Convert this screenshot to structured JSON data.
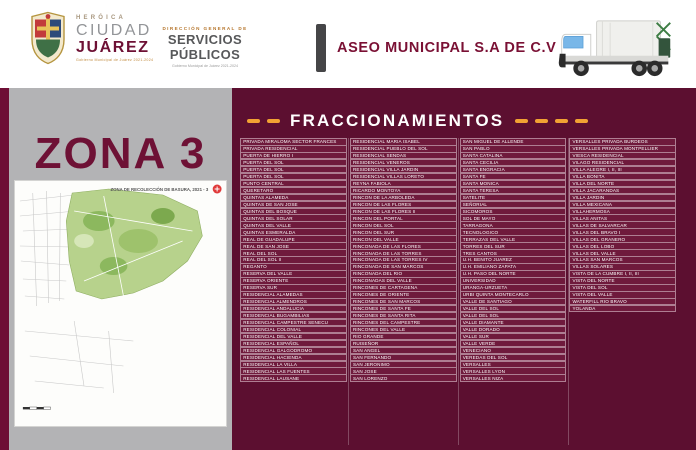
{
  "header": {
    "brand": {
      "heroica": "HERÓICA",
      "ciudad": "CIUDAD",
      "juarez": "JUÁREZ",
      "tagline": "Gobierno Municipal de Juárez 2021-2024"
    },
    "direction": {
      "small": "DIRECCIÓN GENERAL DE",
      "title": "SERVICIOS PÚBLICOS",
      "tagline": "Gobierno Municipal de Juárez 2021-2024"
    },
    "company": "ASEO MUNICIPAL S.A DE C.V"
  },
  "zone": {
    "title": "ZONA 3",
    "map_title": "ZONA DE RECOLECCIÓN DE BASURA, 2021 - 3"
  },
  "fraccionamientos": {
    "title": "FRACCIONAMIENTOS",
    "columns": [
      [
        "PRIVADA MIRALOMA SECTOR FRANCES",
        "PRIVADA RESIDENCIAL",
        "PUERTA DE HIERRO I",
        "PUERTA DEL SOL",
        "PUERTA DEL SOL",
        "PUERTA DEL SOL",
        "PUNTO CENTRAL",
        "QUERETARO",
        "QUINTAS ALAMEDA",
        "QUINTAS DE SAN JOSE",
        "QUINTAS DEL BOSQUE",
        "QUINTAS DEL SOLAR",
        "QUINTAS DEL VALLE",
        "QUINTAS ESMERALDA",
        "REAL DE GUADALUPE",
        "REAL DE SAN JOSE",
        "REAL DEL SOL",
        "REAL DEL SOL II",
        "REGANTO",
        "RESERVA DEL VALLE",
        "RESERVA ORIENTE",
        "RESERVA SUR",
        "RESIDENCIAL ALAMEDAS",
        "RESIDENCIAL ALMENDROS",
        "RESIDENCIAL ANDALUCIA",
        "RESIDENCIAL BUGAMBILIAS",
        "RESIDENCIAL CAMPESTRE SENECU",
        "RESIDENCIAL COLONIAL",
        "RESIDENCIAL DEL VALLE",
        "RESIDENCIAL ESPAÑOL",
        "RESIDENCIAL GALGODROMO",
        "RESIDENCIAL HACIENDA",
        "RESIDENCIAL LA VILLA",
        "RESIDENCIAL LAS FUENTES",
        "RESIDENCIAL LAUSANE"
      ],
      [
        "RESIDENCIAL MARIA ISABEL",
        "RESIDENCIAL PUEBLO DEL SOL",
        "RESIDENCIAL SENDAS",
        "RESIDENCIAL VENEROS",
        "RESIDENCIAL VILLA JARDIN",
        "RESIDENCIAL VILLAS LORETO",
        "REYNA FABIOLA",
        "RICARDO MONTOYA",
        "RINCON DE LA ARBOLEDA",
        "RINCON DE LAS FLORES",
        "RINCON DE LAS FLORES II",
        "RINCON DEL PORTAL",
        "RINCON DEL SOL",
        "RINCON DEL SUR",
        "RINCON DEL VALLE",
        "RINCONADA DE LAS FLORES",
        "RINCONADA DE LAS TORRES",
        "RINCONADA DE LAS TORRES IV",
        "RINCONADA DE SAN MARCOS",
        "RINCONADA DEL RIO",
        "RINCONADAS DEL VALLE",
        "RINCONES DE CARTAGENA",
        "RINCONES DE ORIENTE",
        "RINCONES DE SAN MARCOS",
        "RINCONES DE SANTA FE",
        "RINCONES DE SANTA RITA",
        "RINCONES DEL CAMPESTRE",
        "RINCONES DEL VALLE",
        "RIO GRANDE",
        "RUISEÑOR",
        "SAN ANGEL",
        "SAN FERNANDO",
        "SAN JERONIMO",
        "SAN JOSE",
        "SAN LORENZO"
      ],
      [
        "SAN MIGUEL DE ALLENDE",
        "SAN PABLO",
        "SANTA CATALINA",
        "SANTA CECILIA",
        "SANTA ENGRACIA",
        "SANTA FE",
        "SANTA MONICA",
        "SANTA TERESA",
        "SATELITE",
        "SEÑORIAL",
        "SICOMOROS",
        "SOL DE MAYO",
        "TARRAGONA",
        "TECNOLOGICO",
        "TERRAZAS DEL VALLE",
        "TORRES DEL SUR",
        "TRES CANTOS",
        "U.H. BENITO JUAREZ",
        "U.H. EMILIANO ZAPATA",
        "U.H. PASO DEL NORTE",
        "UNIVERSIDAD",
        "URANGA-URZUETA",
        "URBI QUINTA MONTECARLO",
        "VALLE DE SANTIAGO",
        "VALLE DEL SOL",
        "VALLE DEL SOL",
        "VALLE DIAMANTE",
        "VALLE DORADO",
        "VALLE SUR",
        "VALLE VERDE",
        "VENECIANO",
        "VEREDAS DEL SOL",
        "VERSALLES",
        "VERSALLES LYON",
        "VERSALLES NIZA"
      ],
      [
        "VERSALLES PRIVADA BURDEOS",
        "VERSALLES PRIVADA MONTPELLIER",
        "VIESCA RESIDENCIAL",
        "VILAGO RESIDENCIAL",
        "VILLA ALEGRE I, II, III",
        "VILLA BONITA",
        "VILLA DEL NORTE",
        "VILLA JACARANDAS",
        "VILLA JARDIN",
        "VILLA MEXICANA",
        "VILLAHERMOSA",
        "VILLAS ANITAS",
        "VILLAS DE SALVARCAR",
        "VILLAS DEL BRAVO I",
        "VILLAS DEL GRANERO",
        "VILLAS DEL LOBO",
        "VILLAS DEL VALLE",
        "VILLAS SAN MARCOS",
        "VILLAS SOLARES",
        "VISTA DE LA CUMBRE I, II, III",
        "VISTA DEL NORTE",
        "VISTA DEL SOL",
        "VISTA DEL VALLE",
        "WATERFILL RIO BRAVO",
        "YOLANDA"
      ]
    ]
  },
  "colors": {
    "maroon_background": "#5C0F30",
    "maroon_row": "#6F1A3C",
    "maroon_accent": "#6D1034",
    "orange_dash": "#F2A233",
    "gray_panel": "#B3B3B5",
    "dark_bar": "#454547",
    "map_green": "#B7D28C"
  }
}
